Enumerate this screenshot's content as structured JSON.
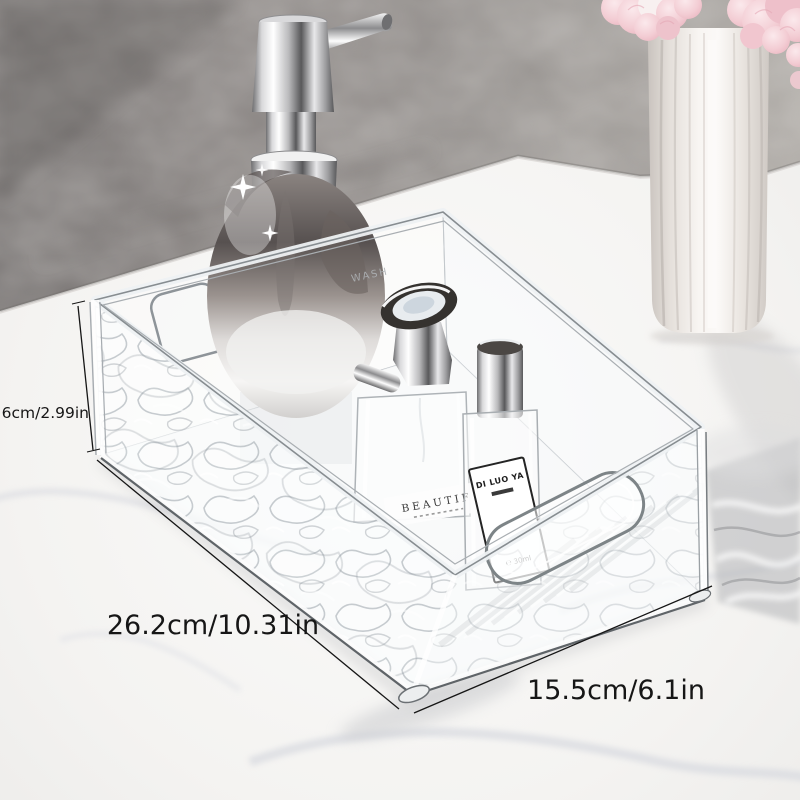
{
  "meta": {
    "type": "product-photo",
    "subject": "Transparent water-ripple acrylic bathroom storage organizer bin on a white marble counter against a gray marble wall, holding a chrome soap dispenser and two perfume bottles; white ribbed vase with pink flowers at top right"
  },
  "dimensions": {
    "height": {
      "label": "7.6cm/2.99in"
    },
    "length": {
      "label": "26.2cm/10.31in"
    },
    "width": {
      "label": "15.5cm/6.1in"
    },
    "text_color": "#161616"
  },
  "bottle_labels": {
    "dispenser_embossed": "WASH",
    "perfume_main_line1": "BEAUTIF",
    "perfume_small_brand": "DI LUO YA",
    "perfume_small_volume": "℮ 30ml"
  },
  "palette": {
    "wall_dark": "#767271",
    "wall_light": "#a8a49f",
    "counter_marble": "#f4f3f1",
    "flower_pink": "#f3ccd4",
    "vase_white": "#f7f4f1",
    "chrome_dark": "#59595b",
    "chrome_light": "#ffffff",
    "glass_edge": "#9aa0a5",
    "annotation_text": "#161616"
  }
}
